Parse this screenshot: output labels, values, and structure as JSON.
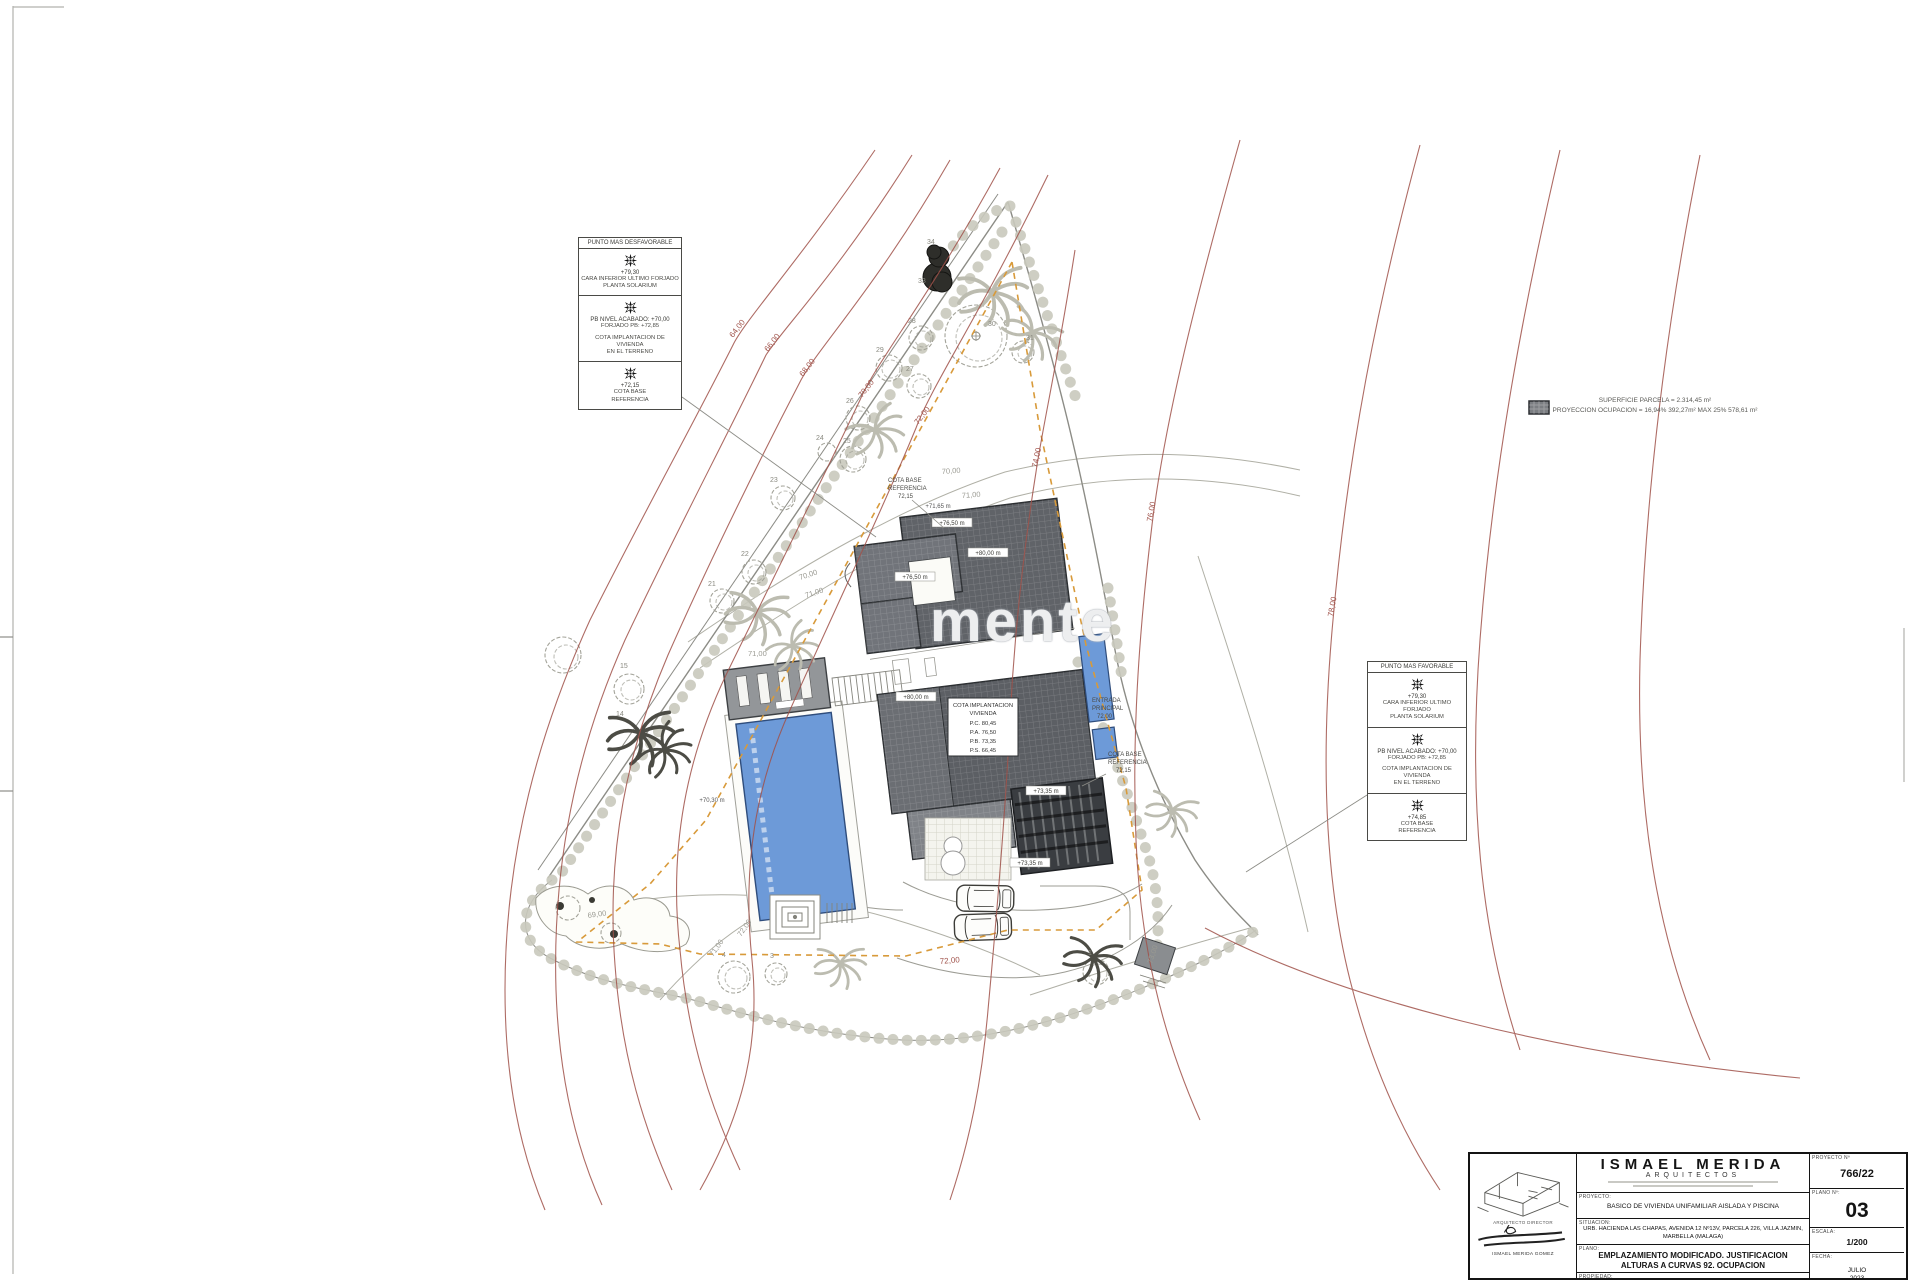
{
  "page": {
    "bg": "#ffffff"
  },
  "watermark": "mente",
  "occupancy": {
    "line1": "SUPERFICIE PARCELA = 2.314,45 m²",
    "line2": "PROYECCION OCUPACION = 16,94%  392,27m²  MAX 25%  578,61 m²"
  },
  "legend_left": {
    "title": "PUNTO MAS DESFAVORABLE",
    "cells": [
      {
        "value": "+79,30",
        "lines": [
          "CARA INFERIOR ULTIMO FORJADO",
          "PLANTA SOLARIUM"
        ]
      },
      {
        "value": "PB NIVEL ACABADO: +70,00",
        "lines": [
          "FORJADO PB: +72,85",
          "COTA IMPLANTACION DE VIVIENDA",
          "EN EL TERRENO"
        ]
      },
      {
        "value": "+72,15",
        "lines": [
          "COTA BASE",
          "REFERENCIA"
        ]
      }
    ]
  },
  "legend_right": {
    "title": "PUNTO MAS FAVORABLE",
    "cells": [
      {
        "value": "+79,30",
        "lines": [
          "CARA INFERIOR ULTIMO FORJADO",
          "PLANTA SOLARIUM"
        ]
      },
      {
        "value": "PB NIVEL ACABADO: +70,00",
        "lines": [
          "FORJADO PB: +72,85",
          "COTA IMPLANTACION DE VIVIENDA",
          "EN EL TERRENO"
        ]
      },
      {
        "value": "+74,85",
        "lines": [
          "COTA BASE",
          "REFERENCIA"
        ]
      }
    ]
  },
  "title_block": {
    "brand": "ISMAEL MERIDA",
    "brand_sub": "ARQUITECTOS",
    "architect_role": "ARQUITECTO DIRECTOR",
    "architect_name": "ISMAEL MERIDA GOMEZ",
    "rows": {
      "proyecto_label": "PROYECTO:",
      "proyecto": "BASICO DE VIVIENDA UNIFAMILIAR AISLADA Y PISCINA",
      "situacion_label": "SITUACION:",
      "situacion": "URB. HACIENDA LAS CHAPAS, AVENIDA 12 Nº13V, PARCELA 226, VILLA JAZMIN, MARBELLA (MALAGA)",
      "plano_label": "PLANO:",
      "plano": "EMPLAZAMIENTO MODIFICADO. JUSTIFICACION ALTURAS A CURVAS 92. OCUPACION",
      "propiedad_label": "PROPIEDAD:",
      "propiedad": "MARTINUS VAN WETTUM"
    },
    "meta": {
      "proyecto_n_label": "PROYECTO Nº",
      "proyecto_n": "766/22",
      "plano_n_label": "PLANO Nº:",
      "plano_n": "03",
      "escala_label": "ESCALA:",
      "escala": "1/200",
      "fecha_label": "FECHA:",
      "fecha_month": "JULIO",
      "fecha_year": "2023"
    }
  },
  "plan": {
    "colors": {
      "contour_red": "#a0524a",
      "terrain_gray": "#9a9a92",
      "pool_blue": "#6d9ad8",
      "setback_orange": "#d89a3a",
      "roof_gray": "#5f6266",
      "hedge": "#c9c9bd"
    },
    "contour_labels_red": [
      "64,00",
      "66,00",
      "68,00",
      "70,00",
      "72,00",
      "74,00",
      "76,00",
      "78,00",
      "72,00"
    ],
    "contour_labels_gray": [
      "69,00",
      "70,00",
      "71,00",
      "70,00",
      "71,00",
      "71,00",
      "72,00",
      "71,00",
      "73,00"
    ],
    "tree_labels": [
      "1",
      "3",
      "4",
      "14",
      "15",
      "21",
      "22",
      "23",
      "24",
      "25",
      "26",
      "27",
      "28",
      "29",
      "30",
      "31",
      "33",
      "34"
    ],
    "level_labels": [
      "+76,50 m",
      "+71,65 m",
      "+80,00 m",
      "+76,50 m",
      "+80,00 m",
      "+73,35 m",
      "+73,35 m",
      "+70,30 m"
    ],
    "house_box_lines": [
      "COTA IMPLANTACION",
      "VIVIENDA",
      "P.C. 80,45",
      "P.A. 76,50",
      "P.B. 73,35",
      "P.S. 66,45"
    ],
    "note_cota_top": [
      "COTA BASE",
      "REFERENCIA",
      "72,15"
    ],
    "note_entrada": [
      "ENTRADA",
      "PRINCIPAL",
      "72,00"
    ],
    "note_cota_right": [
      "COTA BASE",
      "REFERENCIA",
      "72,15"
    ]
  }
}
